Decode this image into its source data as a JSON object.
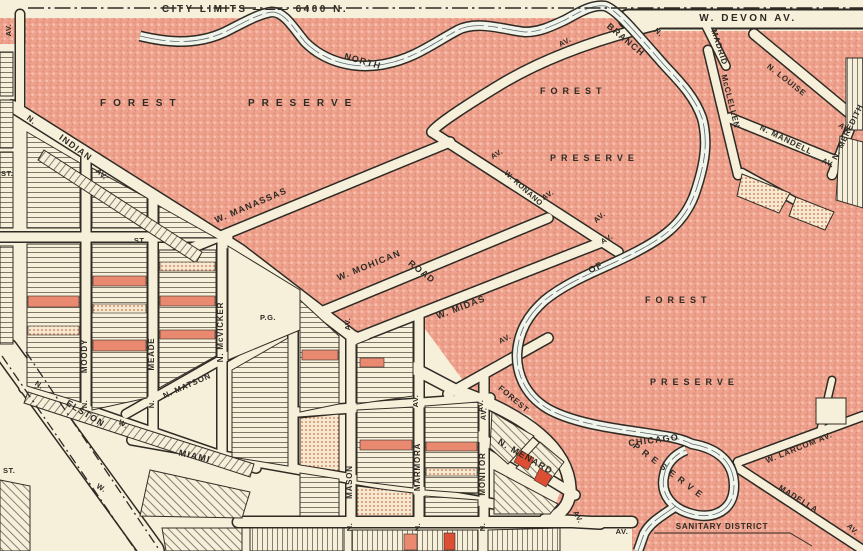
{
  "map_title": "Street map — Forest Preserve / North Branch area, city limits 6400 N",
  "colors": {
    "land_pink": "#efa28e",
    "paper_cream": "#f6f0da",
    "ink": "#2e2a24",
    "lot_red": "#e98a70",
    "river_white": "#f1f4ea"
  },
  "labels": {
    "city_limits": "CITY  LIMITS ——— 6400 N.",
    "devon": "W.  DEVON  AV.",
    "north": "NORTH",
    "branch": "BRANCH",
    "of": "OF",
    "chicago": "CHICAGO",
    "forest": "FOREST",
    "preserve": "PRESERVE",
    "indian": "INDIAN",
    "road": "ROAD",
    "w_manassas": "W.  MANASSAS",
    "w_mohican": "W.  MOHICAN",
    "w_midas": "W.  MIDAS",
    "w_ronano": "W. RONANO",
    "moody": "MOODY",
    "meade": "MEADE",
    "n_mcvicker": "N. McVICKER",
    "n_matson": "N. MATSON",
    "elston": "ELSTON",
    "miami": "MIAMI",
    "mason": "MASON",
    "marmora": "MARMORA",
    "monitor": "MONITOR",
    "n_menard": "N.  MENARD",
    "madrid": "MADRID",
    "mcclellen": "McCLELLEN",
    "n_louise": "N.  LOUISE",
    "n_mandell": "N.  MANDELL",
    "n_meredith": "N. MEREDITH",
    "w_larcom_av": "W. LARCOM  AV.",
    "madella": "MADELLA",
    "sanitary_district": "SANITARY  DISTRICT",
    "pg": "P.G.",
    "av": "AV.",
    "n": "N.",
    "w": "W.",
    "st": "ST."
  }
}
